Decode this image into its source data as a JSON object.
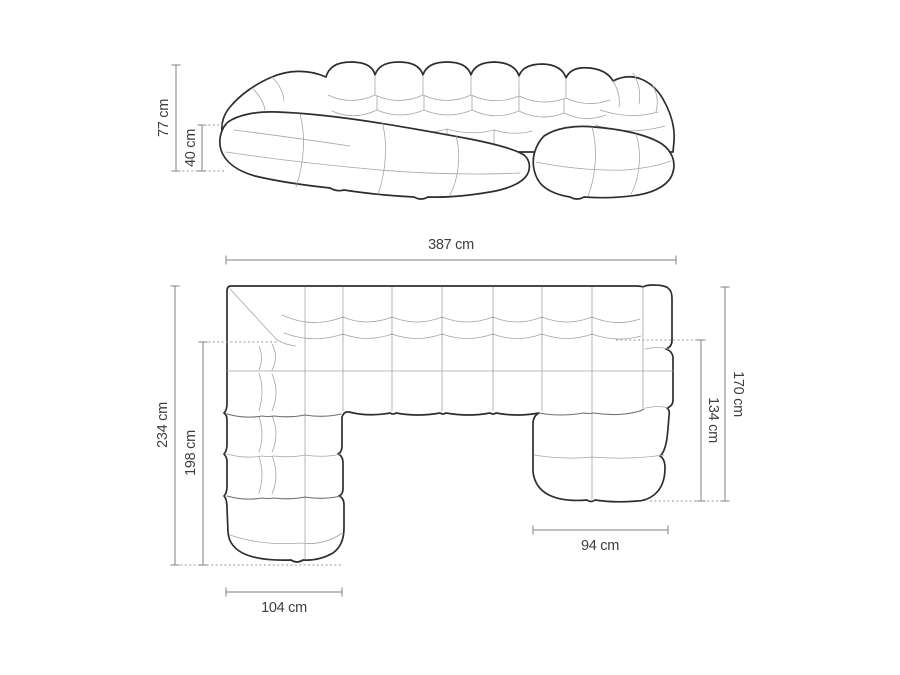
{
  "diagram": {
    "subject": "u-shaped-modular-sofa-dimension-drawing",
    "unit": "cm",
    "front_view": {
      "total_height": "77 cm",
      "seat_height": "40 cm"
    },
    "top_view": {
      "total_width": "387 cm",
      "left_side_depth": "234 cm",
      "left_inner_depth": "198 cm",
      "right_side_depth": "170 cm",
      "right_inner_depth": "134 cm",
      "left_chaise_width": "104 cm",
      "right_chaise_width": "94 cm"
    },
    "colors": {
      "background": "#ffffff",
      "outline": "#2e2e2e",
      "seam": "#a5a5a5",
      "dimension_line": "#828282",
      "label_text": "#3e3e3e"
    }
  }
}
